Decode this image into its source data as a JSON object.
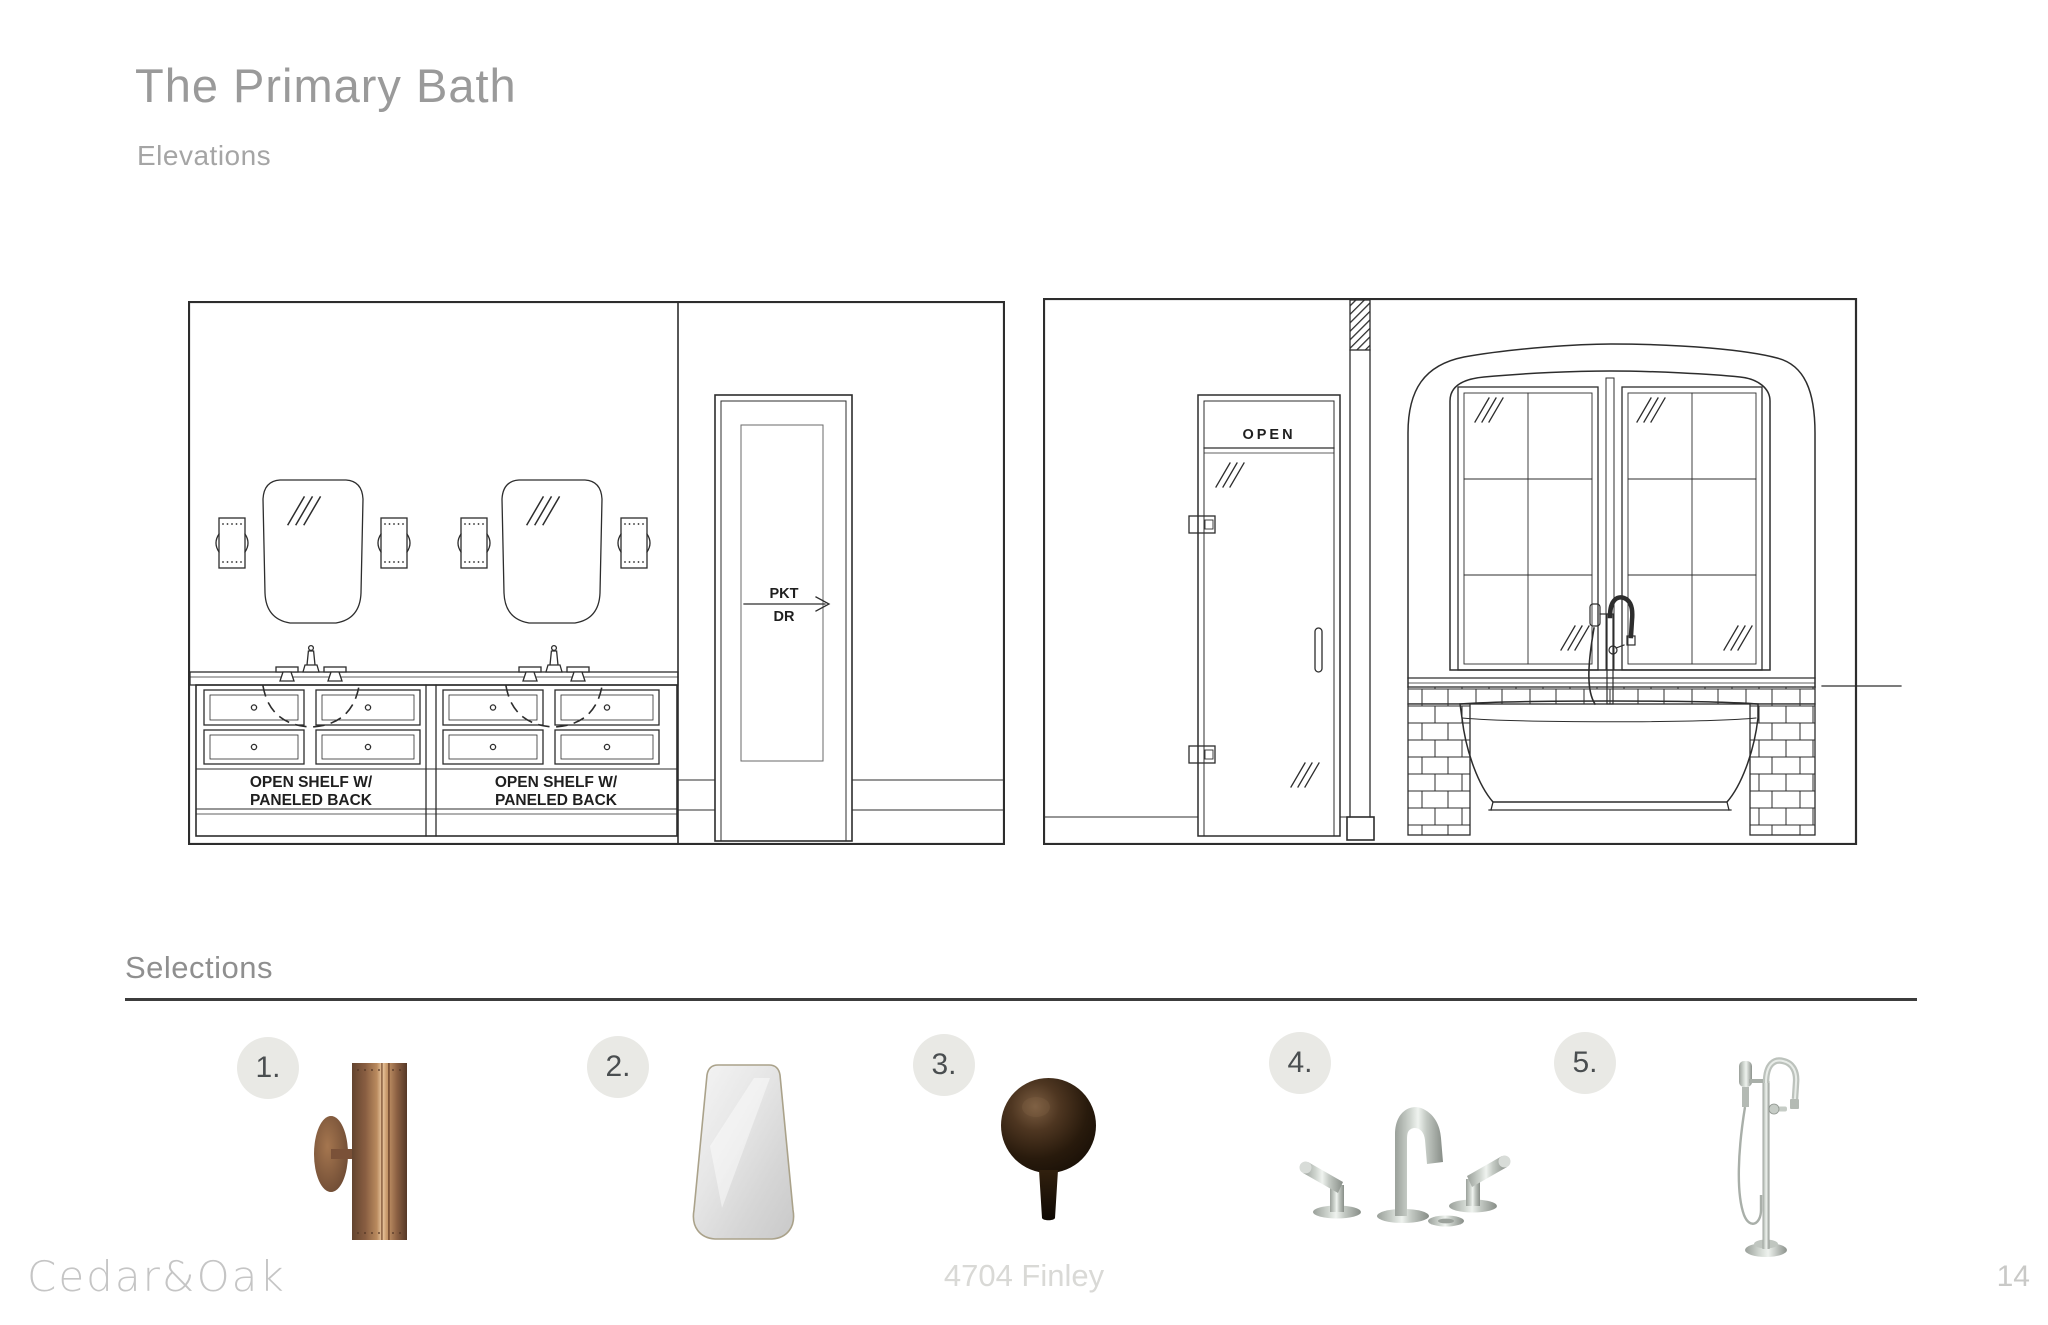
{
  "header": {
    "title": "The Primary Bath",
    "subtitle": "Elevations"
  },
  "elevations": {
    "left": {
      "open_shelf_line1": "OPEN SHELF W/",
      "open_shelf_line2": "PANELED BACK",
      "pocket_door_line1": "PKT",
      "pocket_door_line2": "DR"
    },
    "right": {
      "shower_door_label": "OPEN"
    }
  },
  "selections": {
    "heading": "Selections",
    "items": [
      {
        "number": "1.",
        "icon": "copper-cylinder-sconce"
      },
      {
        "number": "2.",
        "icon": "brass-trapezoid-mirror"
      },
      {
        "number": "3.",
        "icon": "bronze-ball-knob"
      },
      {
        "number": "4.",
        "icon": "widespread-lavatory-faucet"
      },
      {
        "number": "5.",
        "icon": "freestanding-tub-filler"
      }
    ]
  },
  "footer": {
    "brand": "Cedar&Oak",
    "project": "4704 Finley",
    "page": "14"
  },
  "colors": {
    "line": "#2d2d2d",
    "title_gray": "#9a9a9a",
    "badge_bg": "#e9e9e5",
    "copper": "#b98a5e",
    "bronze": "#281a0c",
    "nickel": "#ccd2cc"
  }
}
